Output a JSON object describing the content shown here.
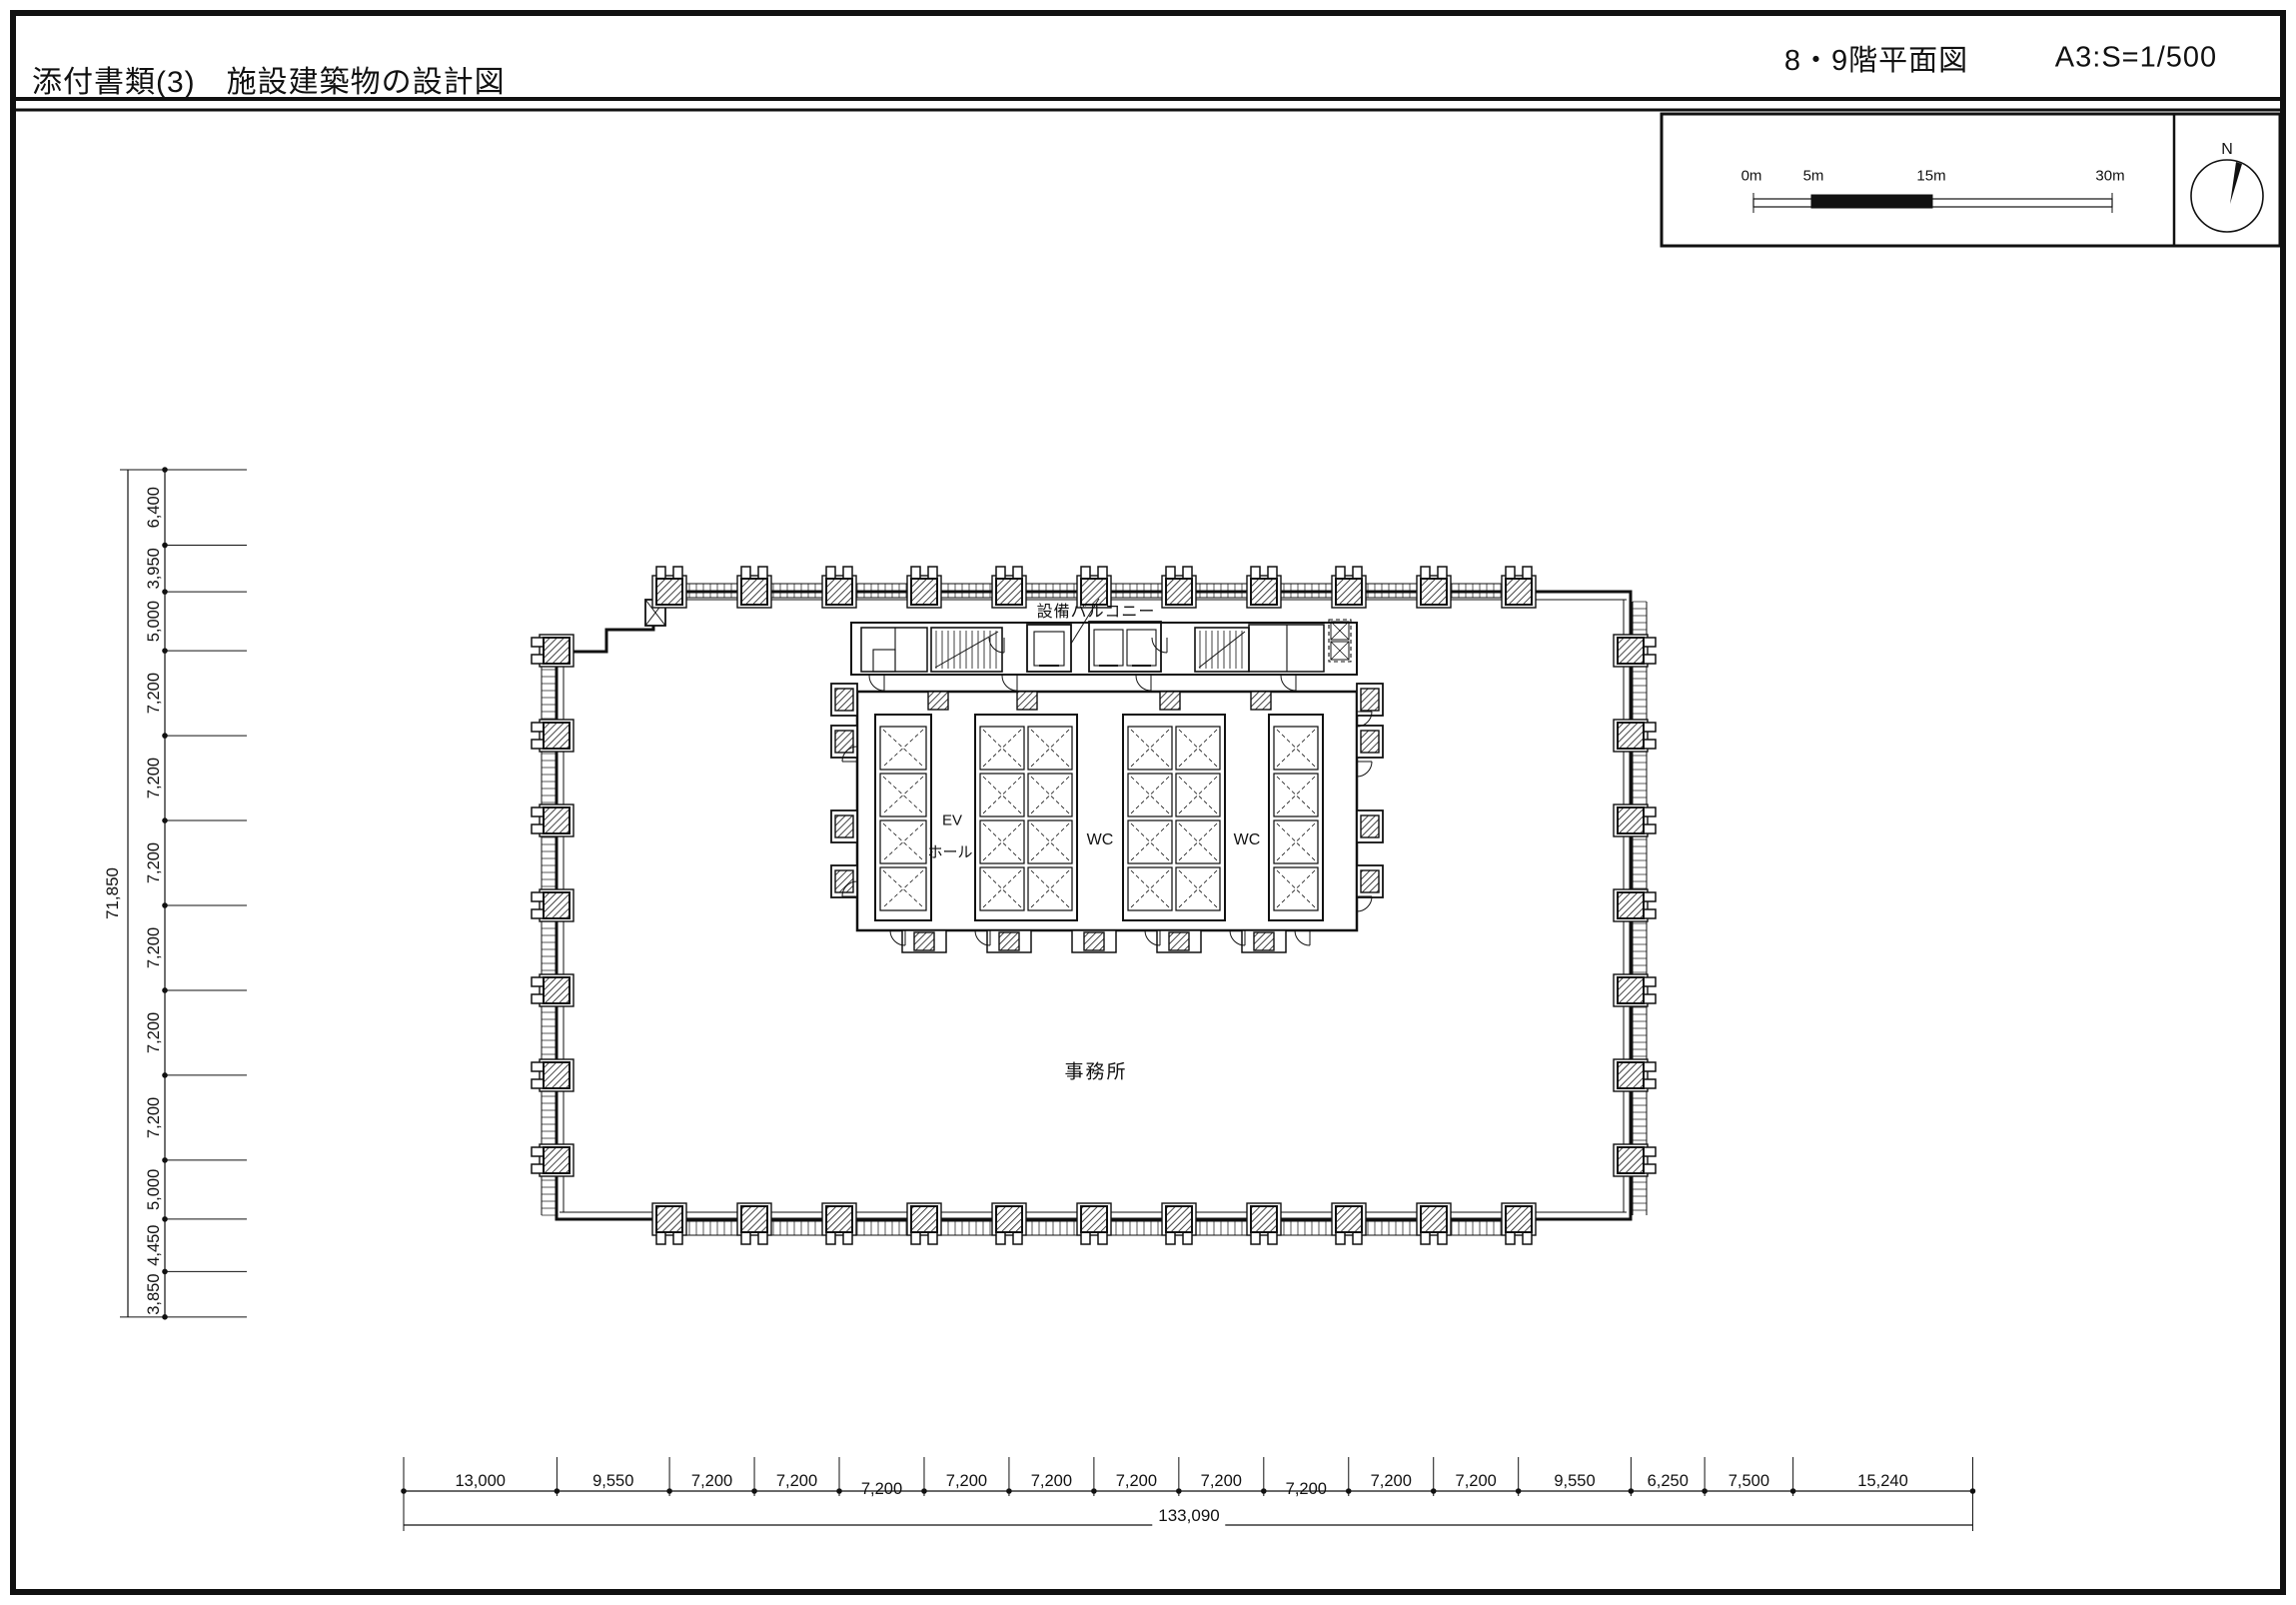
{
  "header": {
    "title": "添付書類(3)　施設建築物の設計図",
    "sheet_title": "8・9階平面図",
    "scale_note": "A3:S=1/500"
  },
  "scale_bar": {
    "labels": [
      "0m",
      "5m",
      "15m",
      "30m"
    ],
    "north_label": "N"
  },
  "plan_labels": {
    "equipment_balcony": "設備バルコニー",
    "ev_line1": "EV",
    "ev_line2": "ホール",
    "wc_left": "WC",
    "wc_right": "WC",
    "office": "事務所"
  },
  "dimensions": {
    "left_chain": {
      "total": "71,850",
      "segments": [
        "6,400",
        "3,950",
        "5,000",
        "7,200",
        "7,200",
        "7,200",
        "7,200",
        "7,200",
        "7,200",
        "5,000",
        "4,450",
        "3,850"
      ]
    },
    "bottom_chain": {
      "total": "133,090",
      "segments": [
        "13,000",
        "9,550",
        "7,200",
        "7,200",
        "7,200",
        "7,200",
        "7,200",
        "7,200",
        "7,200",
        "7,200",
        "7,200",
        "7,200",
        "9,550",
        "6,250",
        "7,500",
        "15,240"
      ]
    }
  }
}
